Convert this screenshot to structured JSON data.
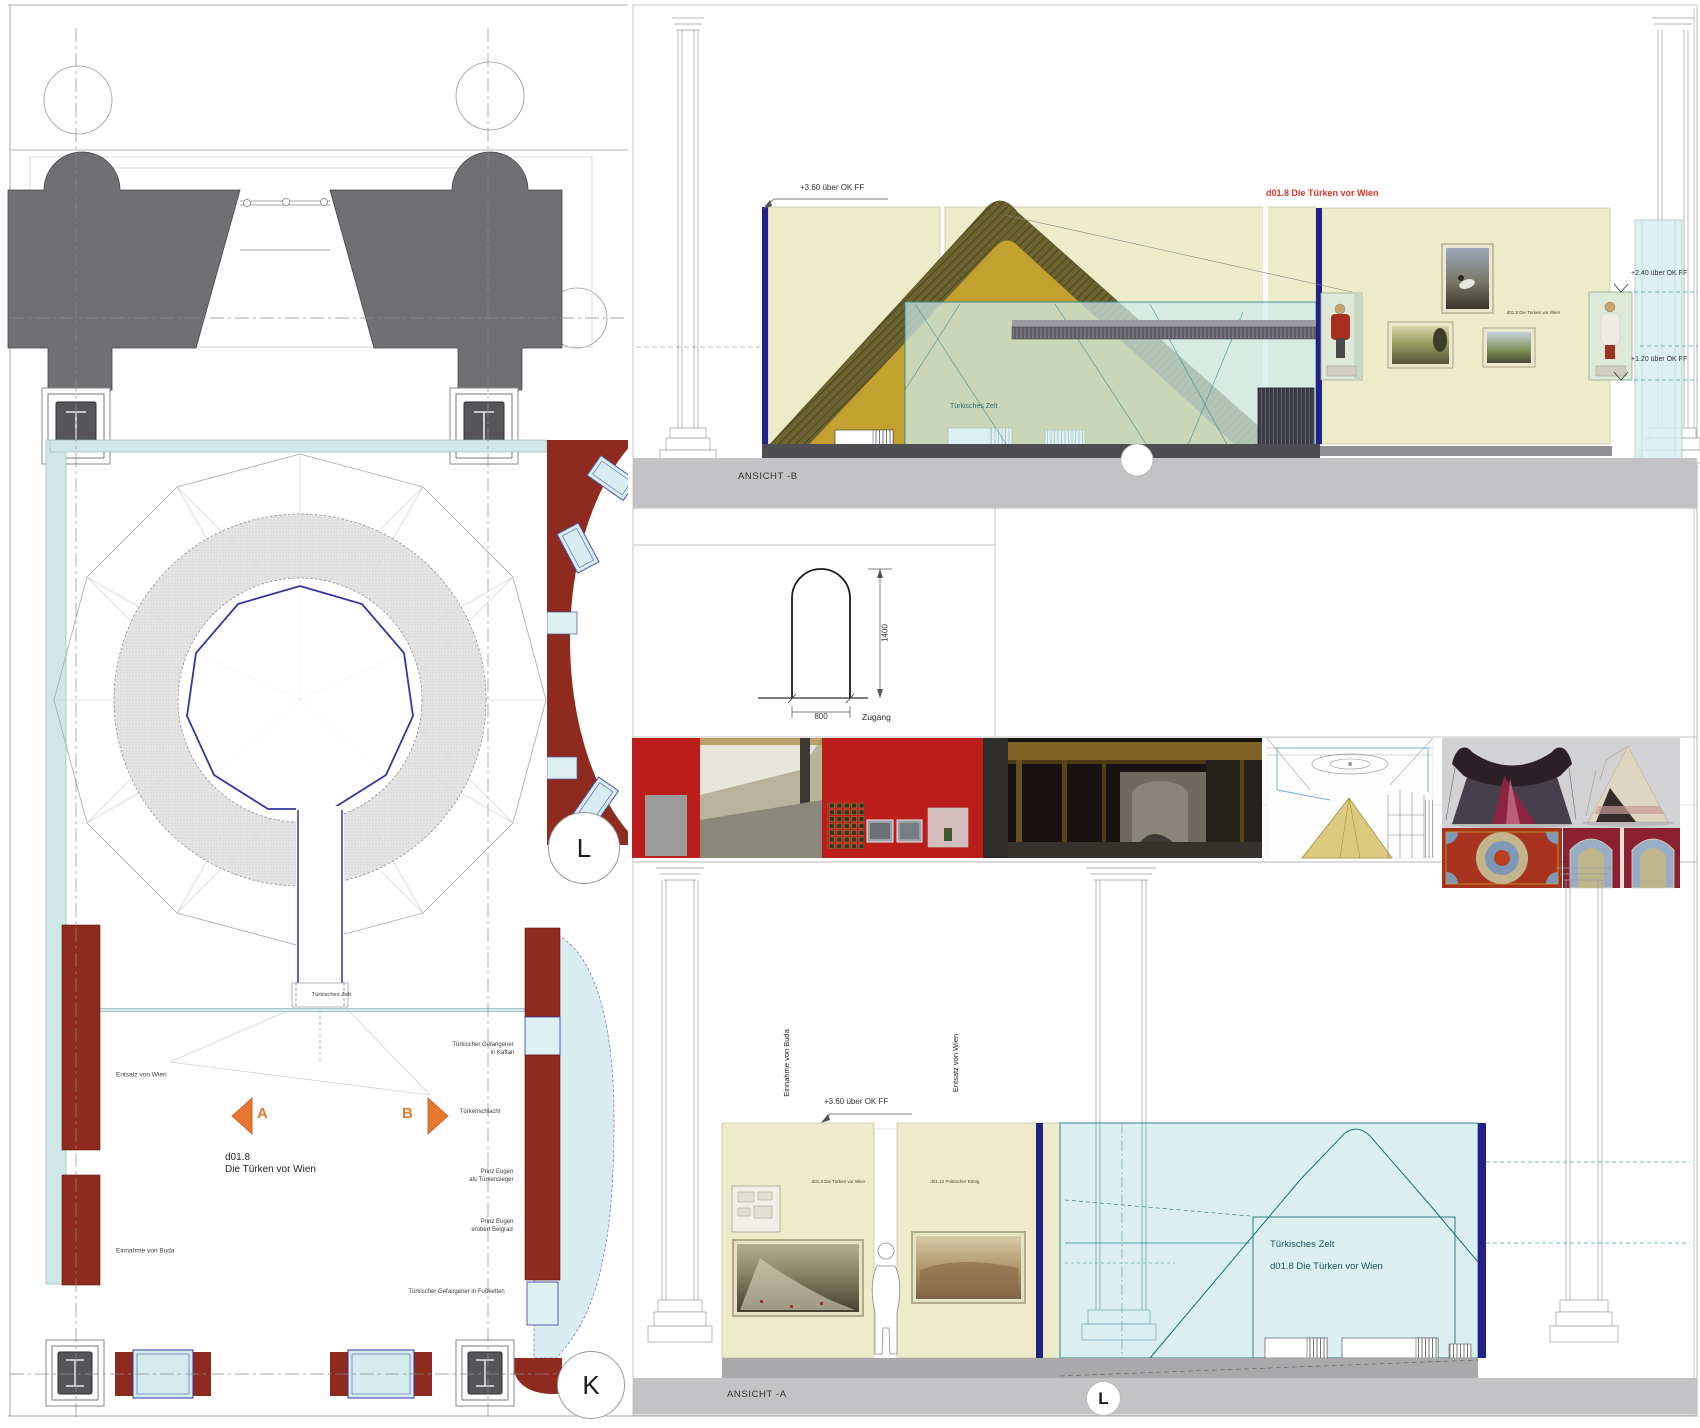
{
  "plan": {
    "tent_label": "Türkisches Zelt",
    "zone_code": "d01.8",
    "zone_name": "Die Türken vor Wien",
    "label_entsatz": "Entsatz von Wien",
    "label_einnahme": "Einnahme von Buda",
    "label_kaftan_line1": "Türkischer Gefangener",
    "label_kaftan_line2": "in Kaftan",
    "label_tuerkenschlacht": "Türkenschlacht",
    "label_sieger_line1": "Prinz Eugen",
    "label_sieger_line2": "als Türkensieger",
    "label_belgrad_line1": "Prinz Eugen",
    "label_belgrad_line2": "erobert Belgrad",
    "label_fussketten": "Türkischer Gefangener in Fußketten",
    "marker_a": "A",
    "marker_b": "B",
    "marker_l": "L",
    "marker_k": "K"
  },
  "ansicht_b": {
    "title": "ANSICHT -B",
    "dim_top": "+3.60 über OK FF",
    "dim_mid": "+2.40 über OK FF",
    "dim_low": "+1.20 über OK FF",
    "red_label": "d01.8 Die Türken vor Wien",
    "glass_label": "Türkisches Zelt",
    "wall_label": "d01.8 Die Türken vor Wien"
  },
  "door_detail": {
    "width_mm": "800",
    "height_mm": "1400",
    "label": "Zugang"
  },
  "ansicht_a": {
    "title": "ANSICHT -A",
    "dim_top": "+3.60 über OK FF",
    "vertical_label_left": "Einnahme von Buda",
    "vertical_label_right": "Entsatz von Wien",
    "wall_a_label": "d01.8 Die Türken vor Wien",
    "wall_b_label": "d01.12 Polnischer König",
    "glass_label_line1": "Türkisches Zelt",
    "glass_label_line2": "d01.8 Die Türken vor Wien",
    "marker_l": "L"
  },
  "colors": {
    "red_wall": "#8f2b1e",
    "orange_marker": "#e8772e",
    "label_red": "#e03426",
    "glass_blue": "#cfe9eb",
    "wall_cream": "#edecca",
    "tent_olive": "#6d6330",
    "tent_gold": "#c3a12f",
    "navy": "#232088",
    "photo_red": "#bb1e1a"
  }
}
